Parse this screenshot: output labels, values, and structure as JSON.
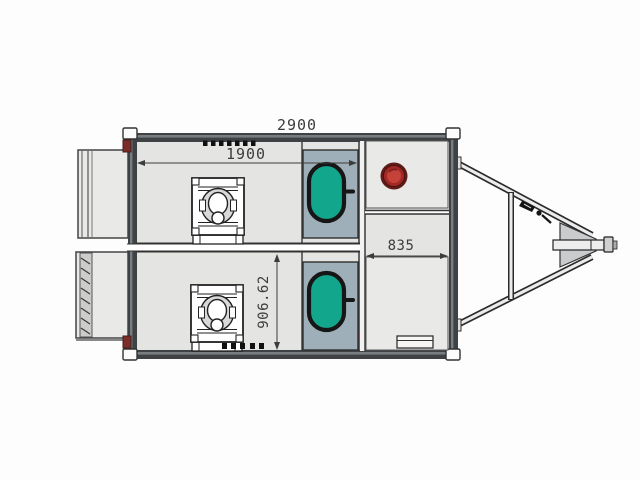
{
  "drawing": {
    "type": "floor-plan",
    "subject": "twin-toilet trailer plan view",
    "dimensions": {
      "overall_width": "2900",
      "interior_width": "1900",
      "room_depth": "906.62",
      "right_compartment_width": "835"
    },
    "colors": {
      "body_fill": "#e4e4e3",
      "wall": "#3e4245",
      "wall_highlight": "#787d81",
      "alcove_fill": "#9fafb9",
      "fixture_green": "#12a78c",
      "access_cap_outer": "#5f1b18",
      "access_cap_mid": "#a32824",
      "access_cap_inner": "#c4423a",
      "corner_accent": "#7b2d28",
      "line_dark": "#2b2b2b"
    }
  }
}
